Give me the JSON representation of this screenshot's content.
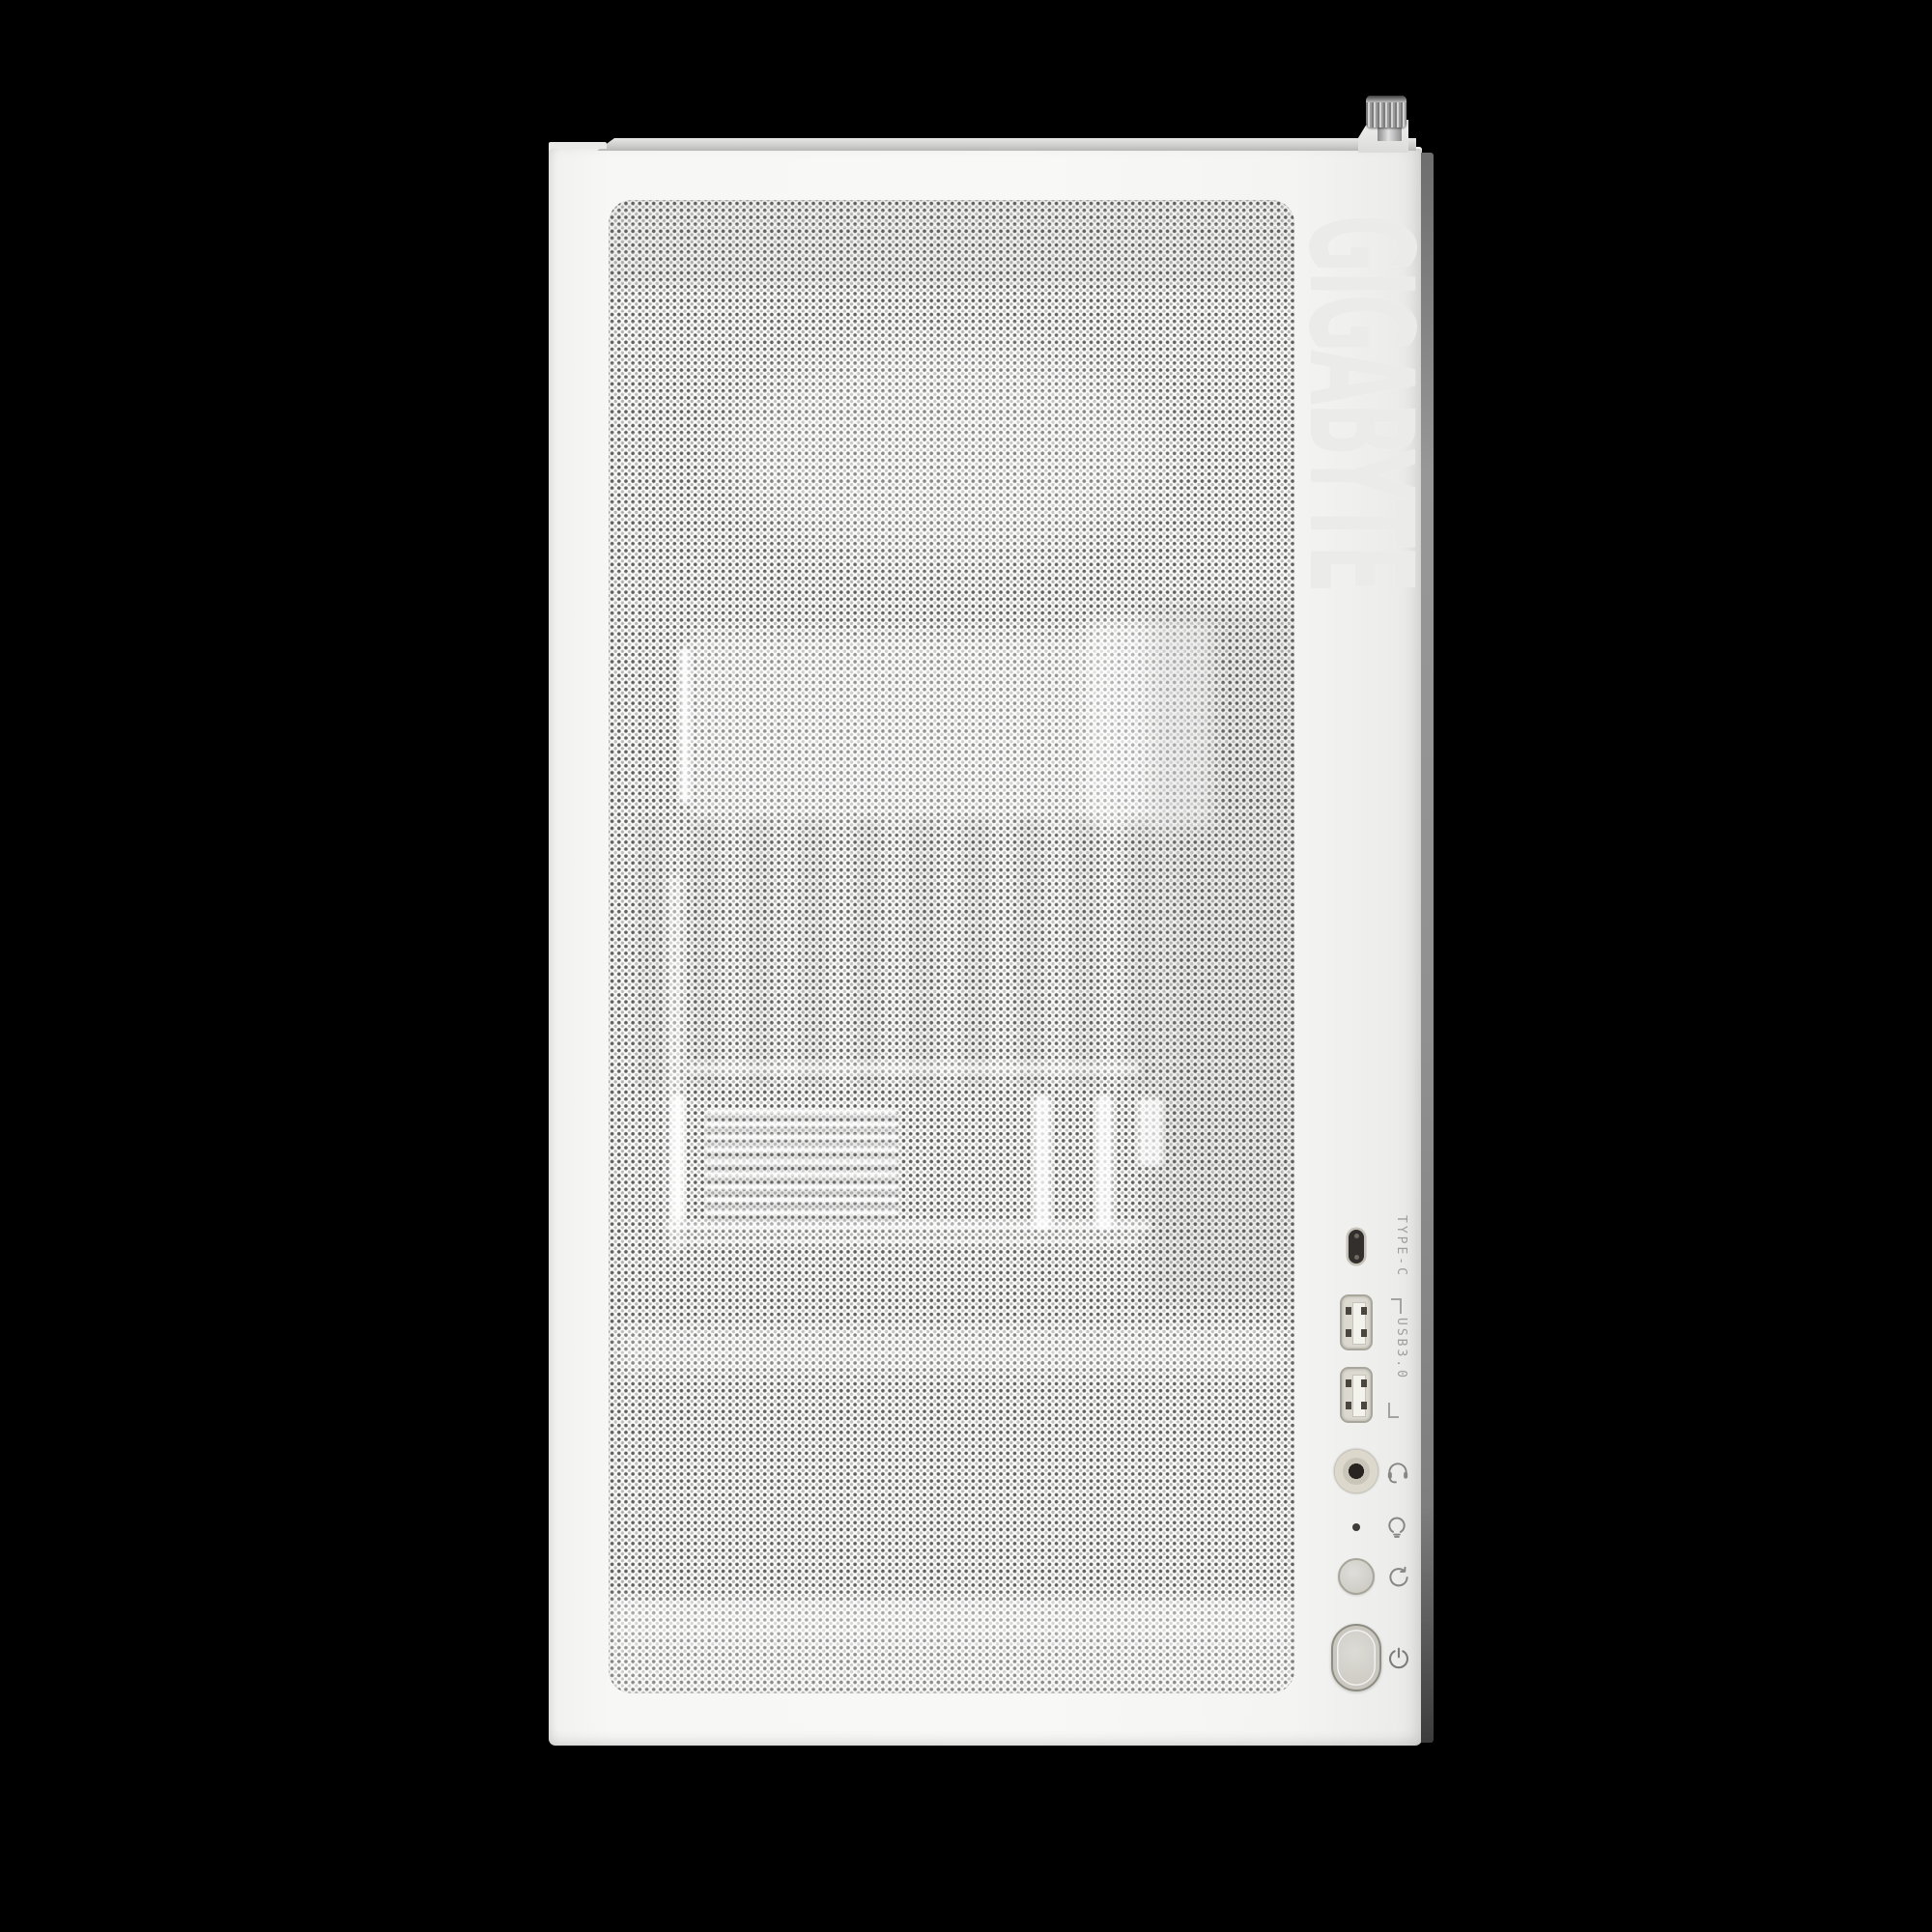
{
  "scene": {
    "background_color": "#000000"
  },
  "case": {
    "brand_text": "GIGABYTE",
    "brand_color": "#ebebe9",
    "front_color": "#f6f6f5",
    "top_lip_color": "#d6d6d4",
    "side_edge_color": "#8a8a8a",
    "mesh_dot_color": "#585858",
    "thumbscrew_color": "#b9b9b9"
  },
  "io_panel": {
    "typec_label": "TYPE-C",
    "usb_label": "USB3.0",
    "label_color": "#9e9e9c",
    "icon_color": "#868684",
    "ports": [
      {
        "name": "usb-type-c-port"
      },
      {
        "name": "usb3-port-top"
      },
      {
        "name": "usb3-port-bottom"
      },
      {
        "name": "audio-combo-jack",
        "icon": "headset-icon"
      },
      {
        "name": "led-indicator",
        "icon": "led-icon"
      },
      {
        "name": "reset-button",
        "icon": "reset-icon"
      },
      {
        "name": "power-button",
        "icon": "power-icon"
      }
    ]
  }
}
